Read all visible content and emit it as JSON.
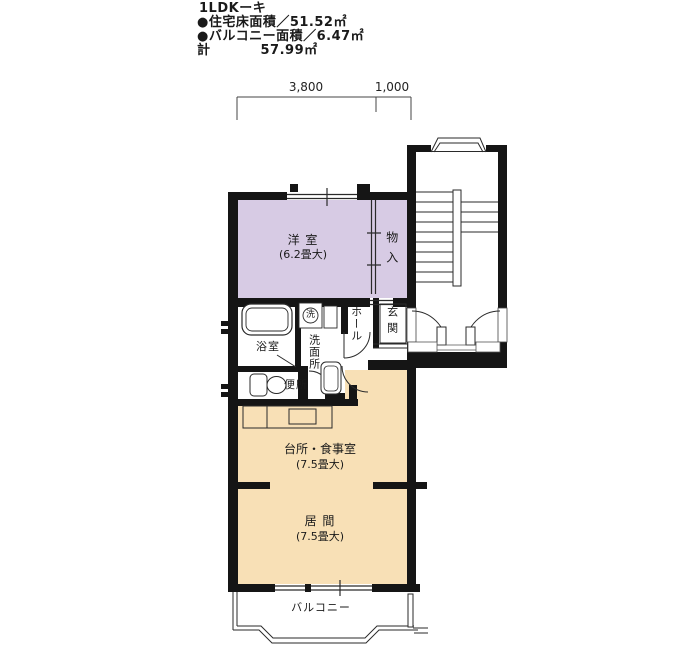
{
  "header": {
    "title": "1LDKーキ",
    "floor_area_line": "●住宅床面積／51.52㎡",
    "balcony_area_line": "●バルコニー面積／6.47㎡",
    "total_label": "計",
    "total_value": "57.99㎡"
  },
  "dimensions": {
    "width_main": "3,800",
    "width_side": "1,000"
  },
  "rooms": {
    "western_room": {
      "name": "洋 室",
      "size": "(6.2畳大)"
    },
    "closet": {
      "name": "物入"
    },
    "bathroom": {
      "name": "浴室"
    },
    "washroom": {
      "name": "洗面所"
    },
    "hall": {
      "name": "ホール"
    },
    "entrance": {
      "name": "玄関"
    },
    "toilet": {
      "name": "便所"
    },
    "washer_symbol": "洗",
    "kitchen_dining": {
      "name": "台所・食事室",
      "size": "(7.5畳大)"
    },
    "living_room": {
      "name": "居 間",
      "size": "(7.5畳大)"
    },
    "balcony": {
      "name": "バルコニー"
    }
  },
  "colors": {
    "room_purple": "#d7cbe4",
    "room_beige": "#f8e0b6",
    "wall": "#151515",
    "line": "#2a2a2a"
  }
}
